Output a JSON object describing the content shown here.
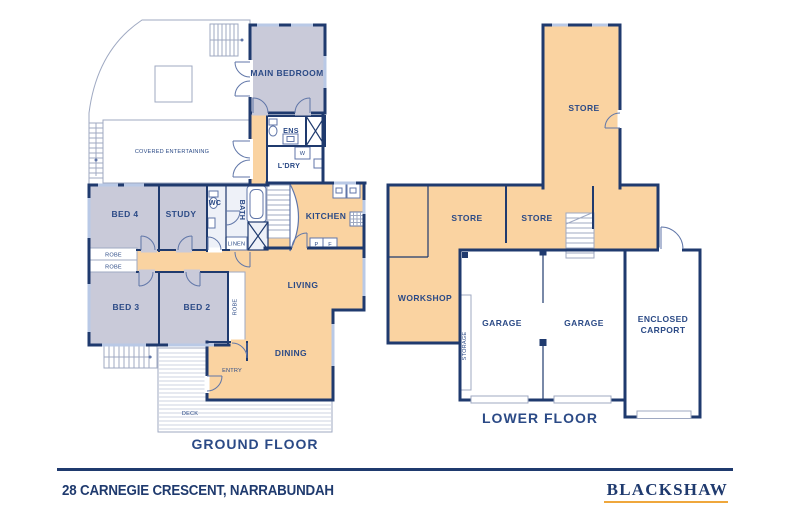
{
  "colors": {
    "navy": "#1f3a6e",
    "text": "#2b4a86",
    "tan": "#fad3a1",
    "lav": "#c9cad9",
    "win": "#b9c9e6",
    "thin": "#9fa9c2",
    "tile": "#eef1f8",
    "deck": "#ccd3e0",
    "gold": "#efa73c"
  },
  "ground_floor": {
    "title": "GROUND FLOOR",
    "labels": {
      "main_bedroom": "MAIN BEDROOM",
      "covered_entertaining": "COVERED ENTERTAINING",
      "ens": "ENS",
      "w": "W",
      "ldry": "L'DRY",
      "wc": "WC",
      "bath": "BATH",
      "linen": "LINEN",
      "kitchen": "KITCHEN",
      "p": "P",
      "f": "F",
      "bed4": "BED 4",
      "study": "STUDY",
      "robe_a": "ROBE",
      "robe_b": "ROBE",
      "robe_c": "ROBE",
      "bed3": "BED 3",
      "bed2": "BED 2",
      "living": "LIVING",
      "dining": "DINING",
      "entry": "ENTRY",
      "deck": "DECK"
    }
  },
  "lower_floor": {
    "title": "LOWER FLOOR",
    "labels": {
      "store_top": "STORE",
      "store_left": "STORE",
      "store_right": "STORE",
      "workshop": "WORKSHOP",
      "garage_left": "GARAGE",
      "garage_right": "GARAGE",
      "enclosed_line1": "ENCLOSED",
      "enclosed_line2": "CARPORT",
      "storage": "STORAGE"
    }
  },
  "footer": {
    "address": "28 CARNEGIE CRESCENT, NARRABUNDAH",
    "brand": "BLACKSHAW"
  }
}
